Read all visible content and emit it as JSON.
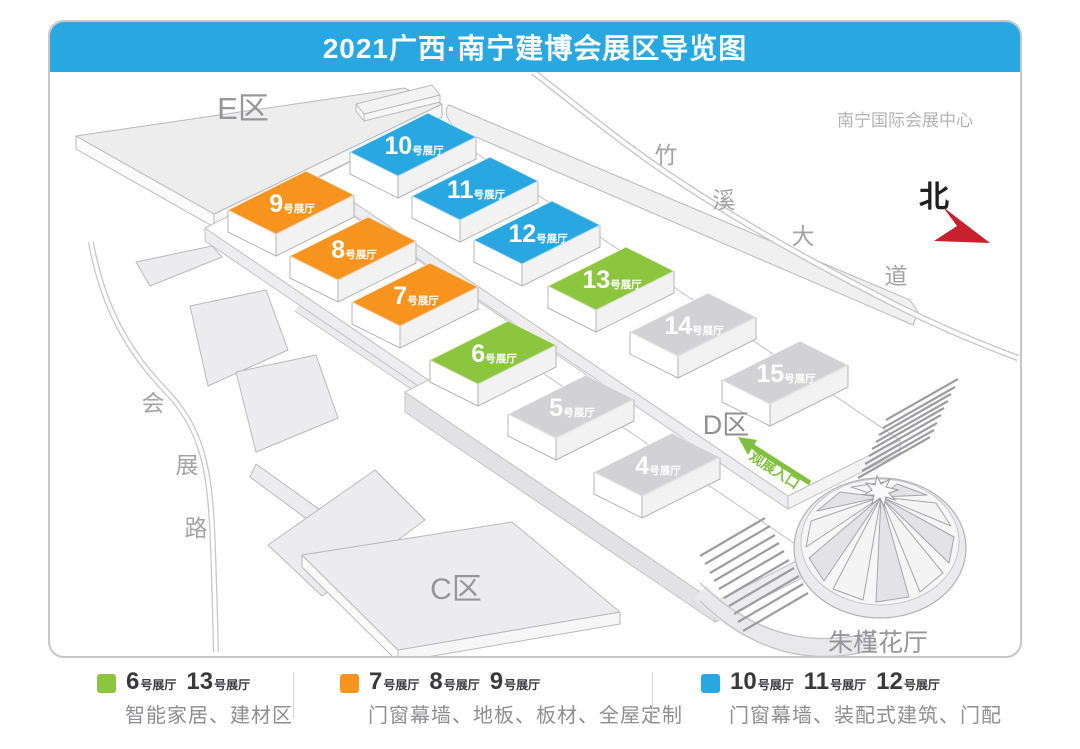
{
  "title": "2021广西·南宁建博会展区导览图",
  "map": {
    "venue_label": "南宁国际会展中心",
    "north_label": "北",
    "flower_hall_label": "朱槿花厅",
    "entrance_label": "观展入口",
    "zone_e": "E区",
    "zone_c": "C区",
    "zone_d": "D区",
    "road_zhuxi_chars": [
      "竹",
      "溪",
      "大",
      "道"
    ],
    "road_huizhan_chars": [
      "会",
      "展",
      "路"
    ],
    "hall_suffix": "号展厅",
    "halls": [
      {
        "number": "10",
        "color": "#29a7e0"
      },
      {
        "number": "11",
        "color": "#29a7e0"
      },
      {
        "number": "12",
        "color": "#29a7e0"
      },
      {
        "number": "13",
        "color": "#8cc63e"
      },
      {
        "number": "14",
        "color": "#d2d2d4"
      },
      {
        "number": "15",
        "color": "#d2d2d4"
      },
      {
        "number": "9",
        "color": "#f7941e"
      },
      {
        "number": "8",
        "color": "#f7941e"
      },
      {
        "number": "7",
        "color": "#f7941e"
      },
      {
        "number": "6",
        "color": "#8cc63e"
      },
      {
        "number": "5",
        "color": "#d2d2d4"
      },
      {
        "number": "4",
        "color": "#d2d2d4"
      }
    ]
  },
  "colors": {
    "banner_blue": "#29a7e0",
    "hall_blue": "#29a7e0",
    "hall_orange": "#f7941e",
    "hall_green": "#8cc63e",
    "hall_gray": "#d2d2d4",
    "north_arrow_red": "#c8202f",
    "entrance_green": "#7fc13e"
  },
  "legend": {
    "suffix": "号展厅",
    "items": [
      {
        "color": "#8cc63e",
        "halls": [
          "6",
          "13"
        ],
        "desc": "智能家居、建材区"
      },
      {
        "color": "#f7941e",
        "halls": [
          "7",
          "8",
          "9"
        ],
        "desc": "门窗幕墙、地板、板材、全屋定制"
      },
      {
        "color": "#29a7e0",
        "halls": [
          "10",
          "11",
          "12"
        ],
        "desc": "门窗幕墙、装配式建筑、门配"
      }
    ]
  }
}
